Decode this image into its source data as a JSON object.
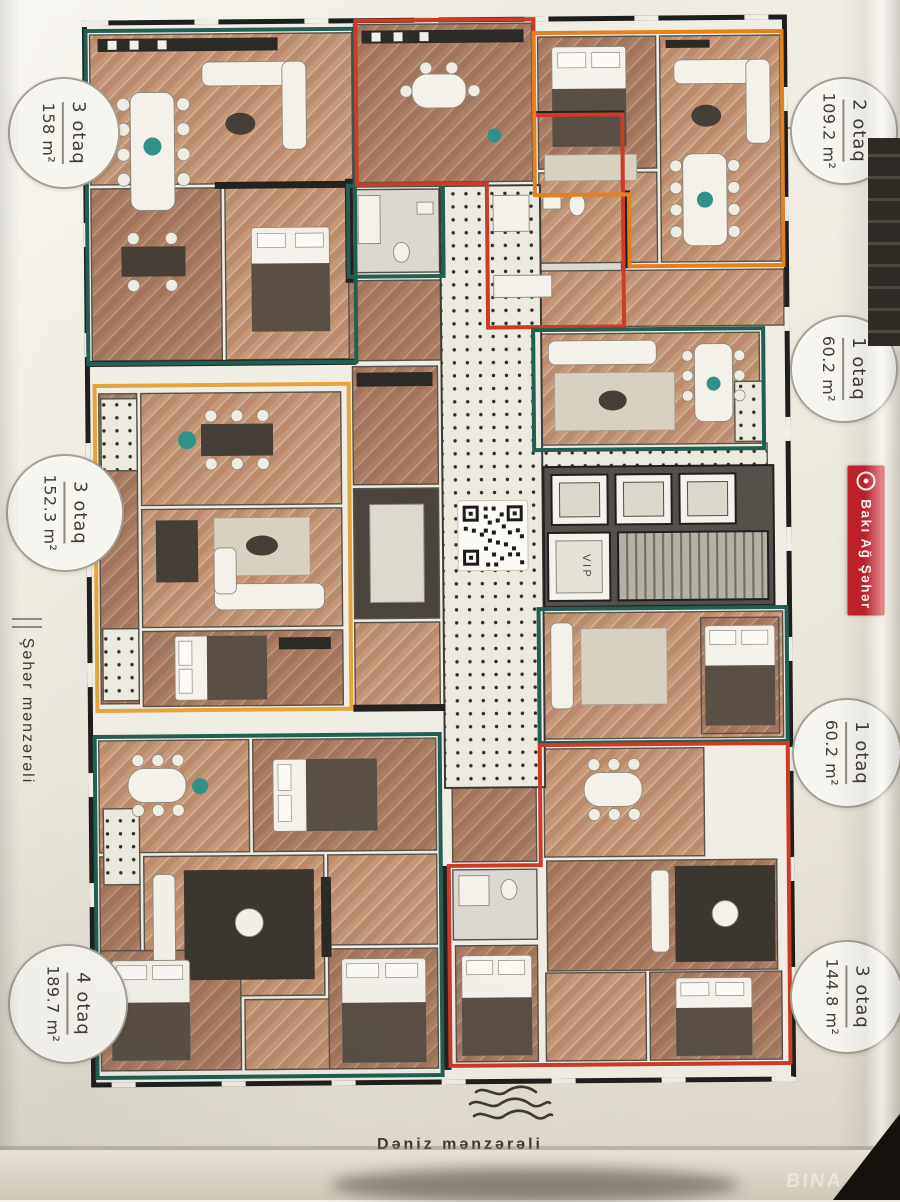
{
  "badges": [
    {
      "rooms": "3 otaq",
      "area": "158 m²",
      "side": "left"
    },
    {
      "rooms": "2 otaq",
      "area": "109.2 m²",
      "side": "right"
    },
    {
      "rooms": "1 otaq",
      "area": "60.2 m²",
      "side": "right"
    },
    {
      "rooms": "3 otaq",
      "area": "152.3 m²",
      "side": "left"
    },
    {
      "rooms": "1 otaq",
      "area": "60.2 m²",
      "side": "right"
    },
    {
      "rooms": "4 otaq",
      "area": "189.7 m²",
      "side": "left"
    },
    {
      "rooms": "3 otaq",
      "area": "144.8 m²",
      "side": "right"
    }
  ],
  "labels": {
    "left_view": "Şəhər mənzərəli",
    "bottom_view": "Dəniz mənzərəli",
    "brand": "Bakı Ağ Şəhər",
    "vip": "VIP",
    "watermark": "BINA.AZ"
  },
  "icons": {
    "brand_logo": "target-circle-icon",
    "sea_view": "waves-icon"
  },
  "colors": {
    "teal": "#235e53",
    "red": "#cc3a28",
    "orange": "#e2811f",
    "amber": "#e5a43c",
    "brandRed": "#c5232a",
    "accentTeal": "#2f9288",
    "paper": "#efebe1"
  }
}
